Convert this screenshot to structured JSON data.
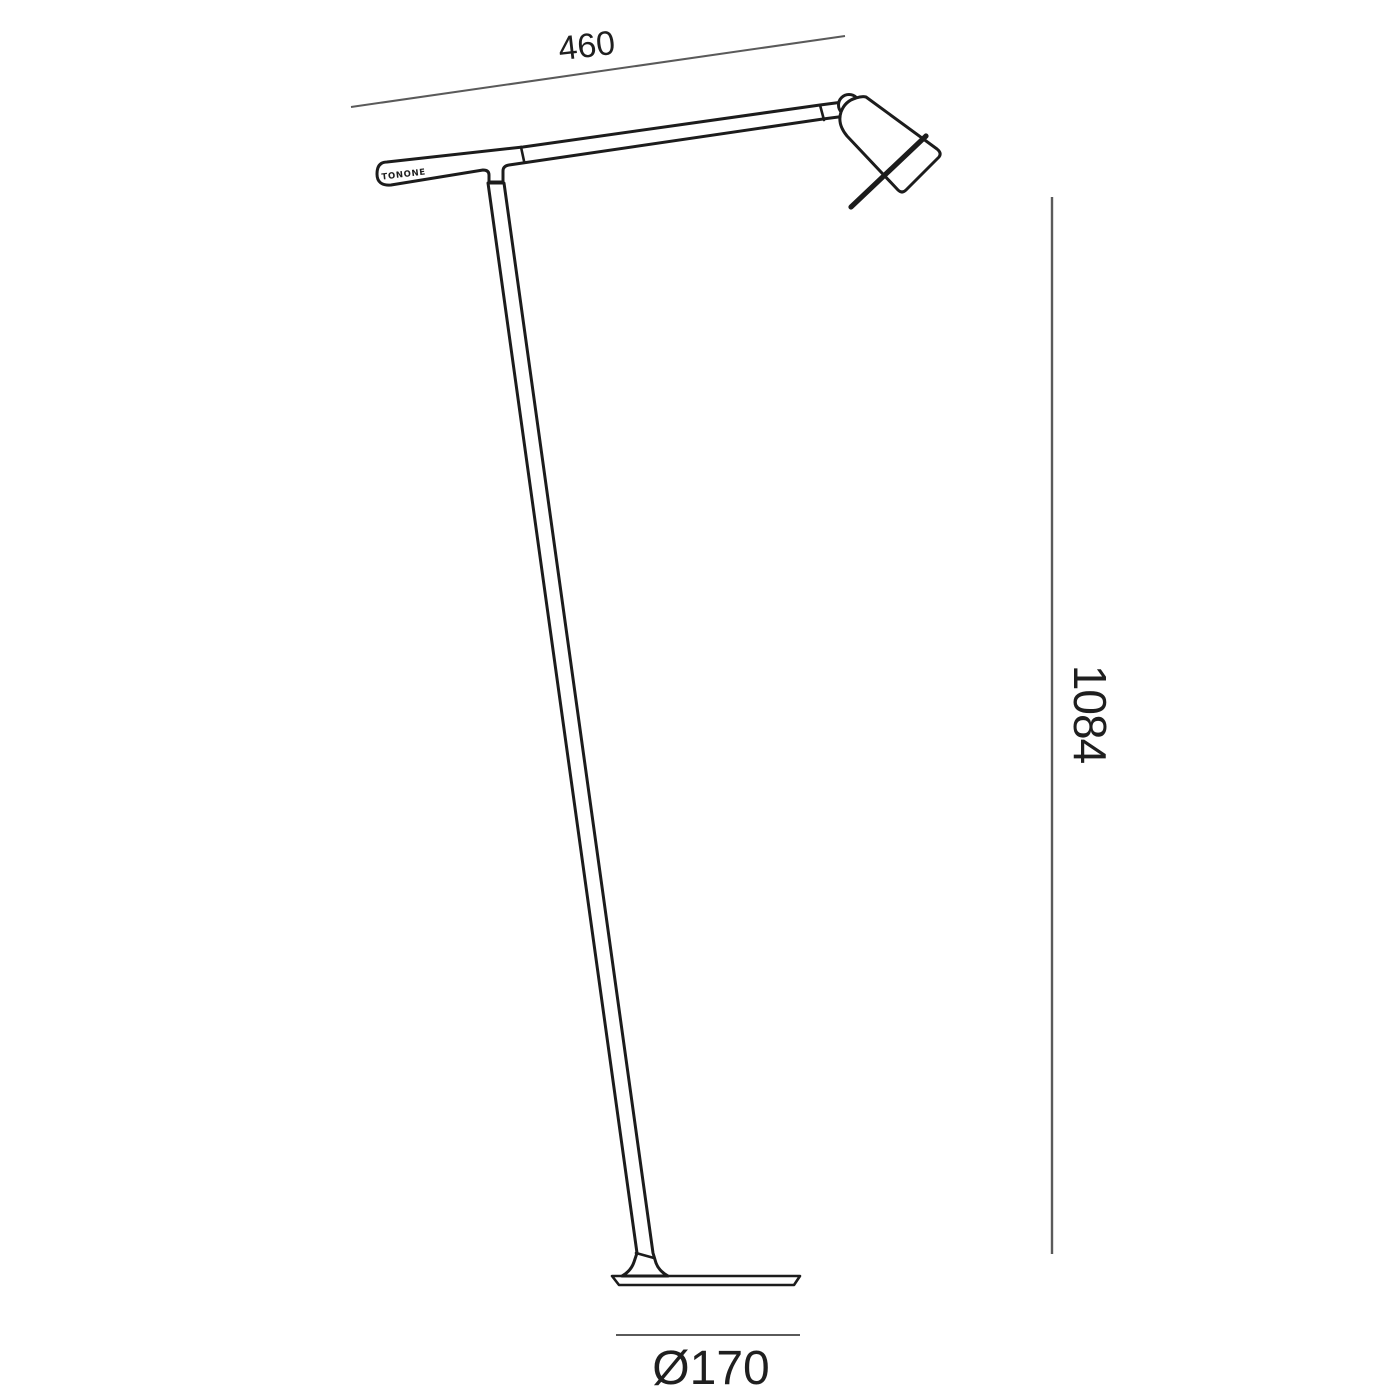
{
  "colors": {
    "outline": "#1c1c1c",
    "dimension_line": "#5a5a5a",
    "text": "#1f1f1f",
    "background": "#ffffff"
  },
  "dimensions": {
    "arm_reach": {
      "value": "460"
    },
    "height": {
      "value": "1084"
    },
    "base_diameter": {
      "value": "Ø170"
    }
  },
  "brand": {
    "logo_text": "TONONE"
  }
}
